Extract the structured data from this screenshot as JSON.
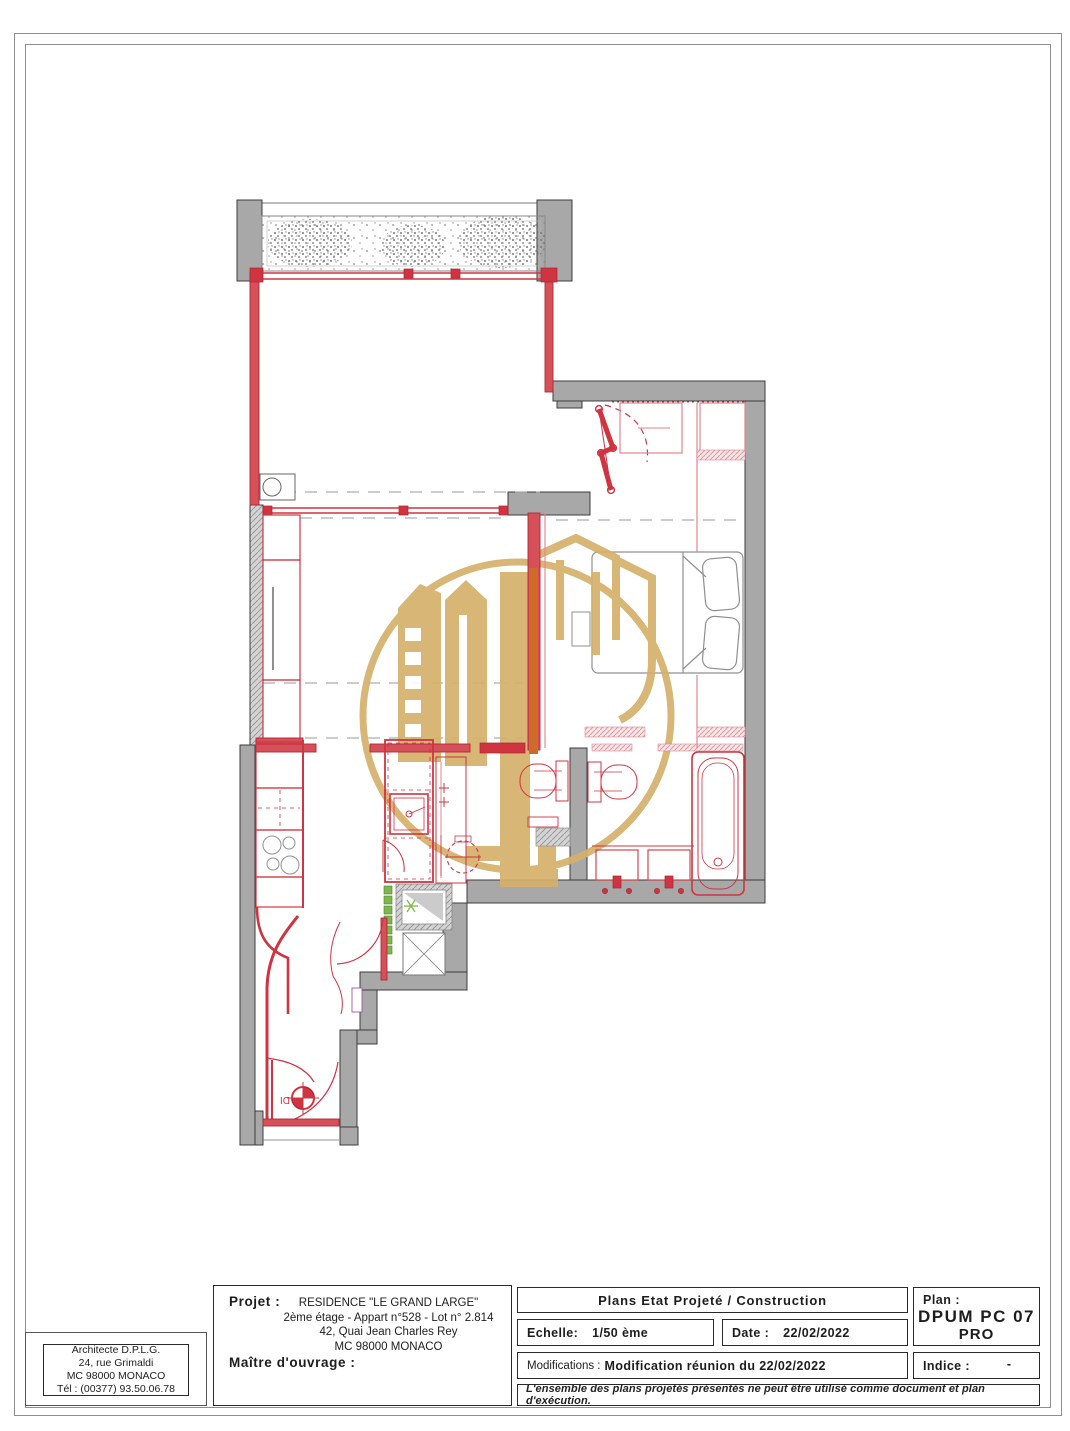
{
  "title_block": {
    "architect": {
      "lines": [
        "Architecte D.P.L.G.",
        "24, rue Grimaldi",
        "MC 98000 MONACO",
        "Tél : (00377) 93.50.06.78"
      ]
    },
    "project": {
      "label": "Projet :",
      "lines": [
        "RESIDENCE \"LE GRAND LARGE\"",
        "2ème étage - Appart n°528 - Lot n° 2.814",
        "42, Quai Jean Charles Rey",
        "MC 98000 MONACO"
      ],
      "owner_label": "Maître d'ouvrage :"
    },
    "plan_title": "Plans Etat Projeté / Construction",
    "scale": {
      "label": "Echelle:",
      "value": "1/50 ème"
    },
    "date": {
      "label": "Date :",
      "value": "22/02/2022"
    },
    "modifications": {
      "label": "Modifications :",
      "value": "Modification réunion du 22/02/2022"
    },
    "plan_ref": {
      "label": "Plan :",
      "code": "DPUM PC 07",
      "phase": "PRO"
    },
    "indice": {
      "label": "Indice :",
      "value": "-"
    },
    "disclaimer": "L'ensemble des plans projetés présentés ne peut être utilisé comme document et plan d'exécution."
  },
  "drawing": {
    "door_label": "DI",
    "colors": {
      "wall_gray": "#a8a8a8",
      "modified_red": "#cf3440",
      "door_orange": "#cf6b28",
      "watermark_gold": "#d4b06b",
      "symbol_green": "#7db84a",
      "pink_line": "#e0858d"
    }
  }
}
